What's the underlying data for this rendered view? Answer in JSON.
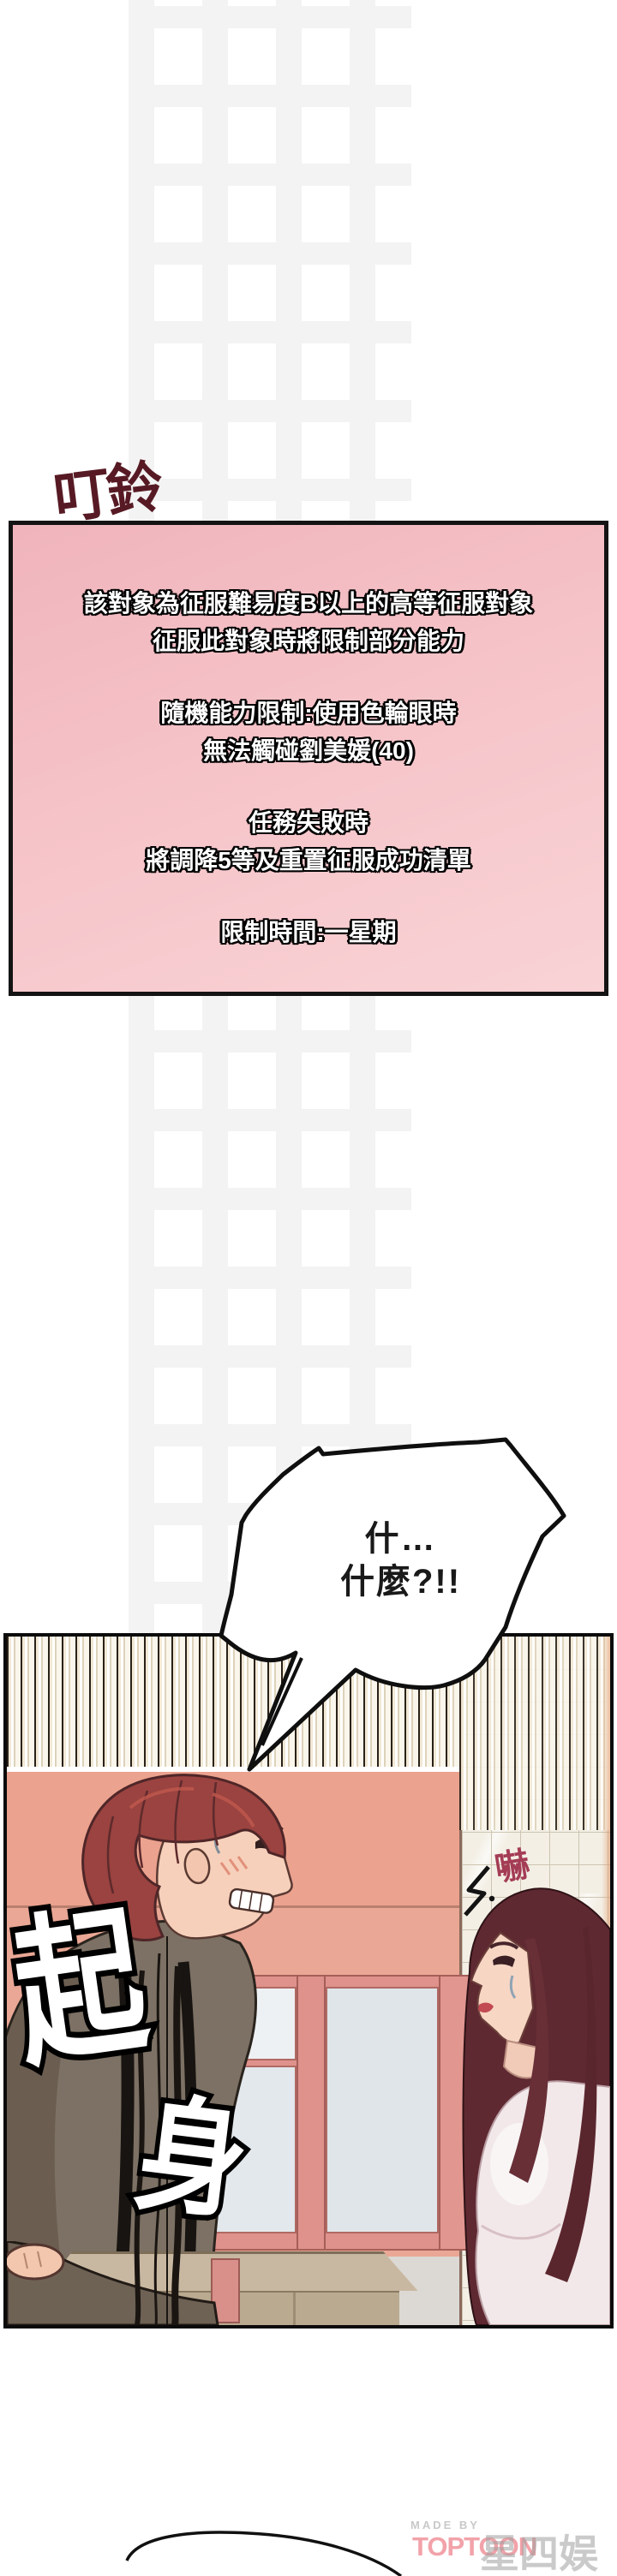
{
  "sfx": {
    "bell": "叮鈴",
    "shout_line1": "什…",
    "shout_line2": "什麼?!!",
    "rise_char1": "起",
    "rise_char2": "身",
    "shock": "嚇"
  },
  "system_box": {
    "lines": [
      "該對象為征服難易度B以上的高等征服對象",
      "征服此對象時將限制部分能力",
      "隨機能力限制:使用色輪眼時",
      "無法觸碰劉美媛(40)",
      "任務失敗時",
      "將調降5等及重置征服成功清單",
      "限制時間:一星期"
    ],
    "colors": {
      "background_top": "#f0b4bc",
      "background_bottom": "#f9d3d6",
      "border": "#141414",
      "text": "#ffffff",
      "text_outline": "#000000"
    }
  },
  "footer": {
    "made_by": "MADE BY",
    "brand": "TOPTOON",
    "watermark": "星四娱乐",
    "colors": {
      "made_by": "#c9c9c9",
      "brand": "#f2a2a9",
      "watermark": "#9e9e9e"
    }
  },
  "panel_colors": {
    "wall_pink": "#eaa795",
    "tile_wall": "#f3efe5",
    "speed_line_cream": "#f1e8d5",
    "man_jacket": "#7c7164",
    "man_hair": "#9a4340",
    "woman_hair": "#5f2931",
    "skin": "#f6d0ba",
    "window_frame": "#df928c",
    "window_pane": "#e2e8ec",
    "table": "#c9b8a1",
    "shock_text": "#a43c55",
    "bubble_fill": "#ffffff",
    "bubble_stroke": "#0f0f0f"
  },
  "icons": {
    "shock_mark": "shock-mark-icon"
  }
}
